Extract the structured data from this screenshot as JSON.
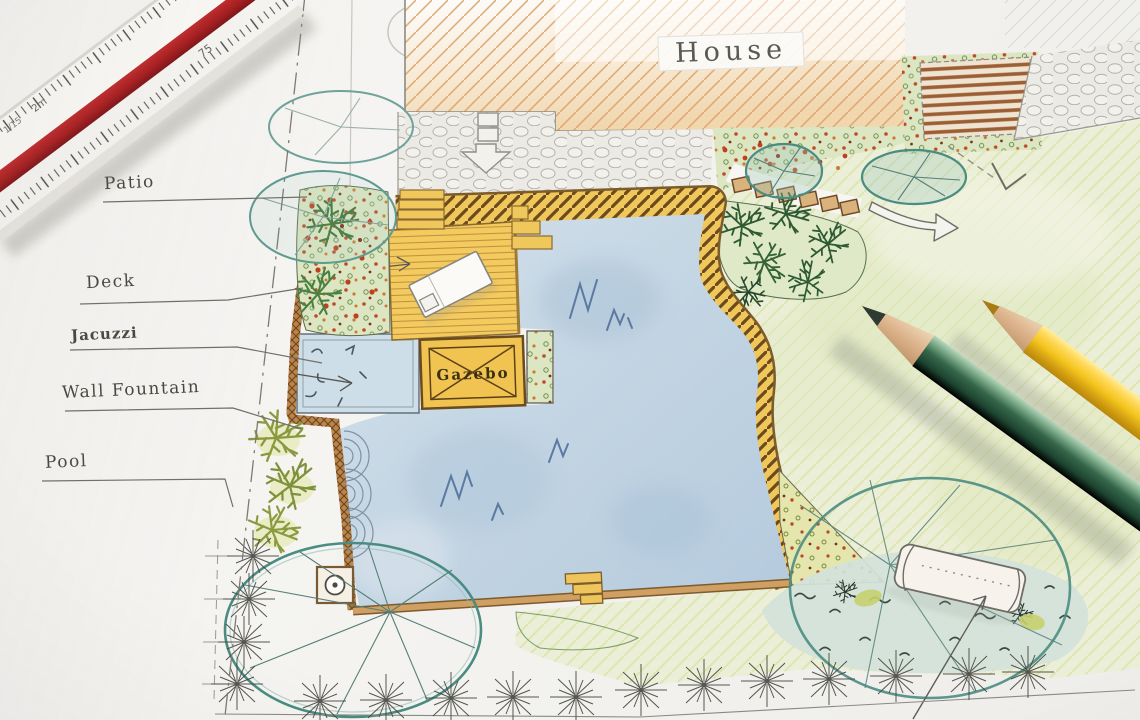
{
  "plan_labels": {
    "house": "House",
    "patio": "Patio",
    "deck": "Deck",
    "jacuzzi": "Jacuzzi",
    "wall_fountain": "Wall Fountain",
    "pool": "Pool",
    "gazebo": "Gazebo"
  },
  "ruler": {
    "markings": [
      "75",
      "2m",
      "1/15"
    ]
  },
  "colors": {
    "paper": "#f4f3f0",
    "pool_water": "#c3d5e3",
    "deck_wood": "#f1c75c",
    "coping_stripe": "#6b4a1e",
    "lawn": "#ecefd7",
    "tree_canopy": "#4a8c82",
    "planting_red": "#bf3f20",
    "wall_brown": "#b9854f",
    "pencil_green": "#2f5f41",
    "pencil_yellow": "#f2c318",
    "ruler_red": "#a81d20"
  }
}
